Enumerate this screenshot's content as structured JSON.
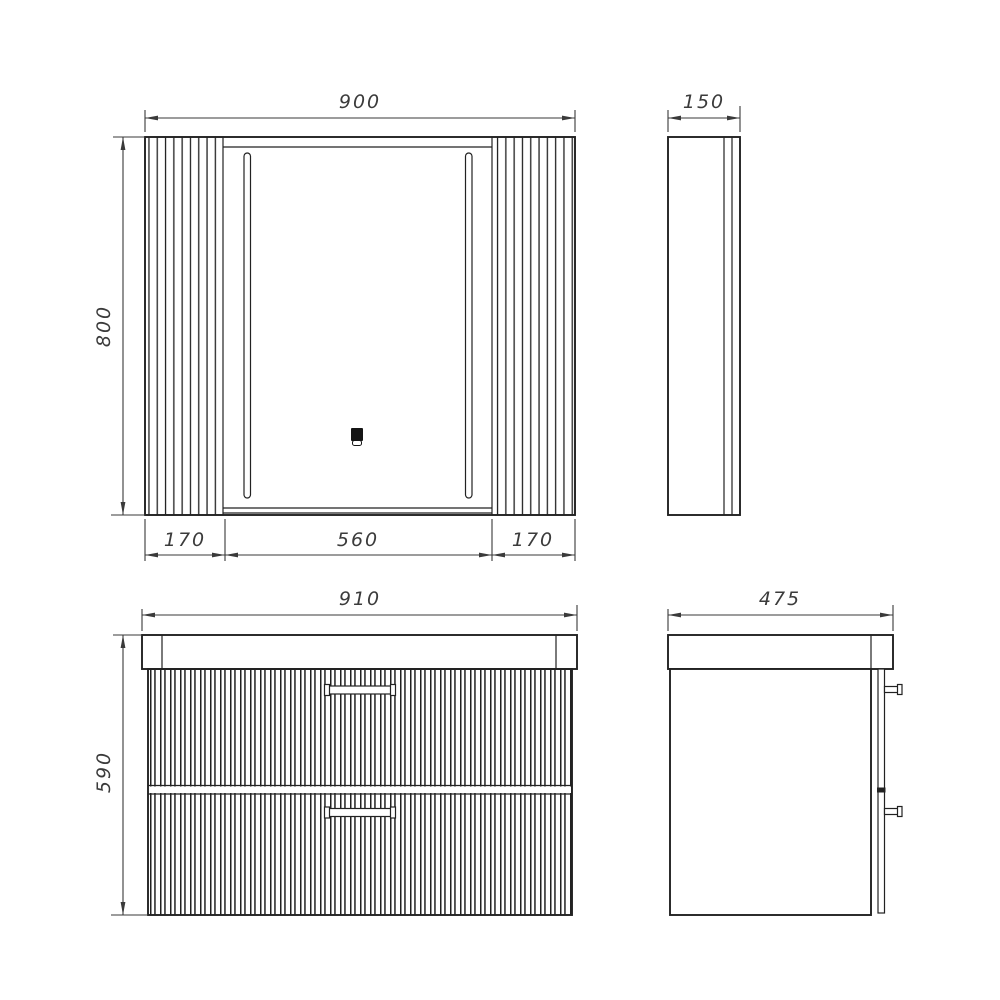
{
  "colors": {
    "background": "#ffffff",
    "line": "#222222",
    "dimension_text": "#3b3b3b"
  },
  "dimensions": {
    "mirror_width": "900",
    "mirror_height": "800",
    "mirror_left_panel": "170",
    "mirror_door": "560",
    "mirror_right_panel": "170",
    "mirror_depth": "150",
    "vanity_width": "910",
    "vanity_height": "590",
    "vanity_depth": "475"
  },
  "icons": {
    "touch_sensor": "touch-sensor-icon",
    "led_strip": "led-strip-icon"
  }
}
